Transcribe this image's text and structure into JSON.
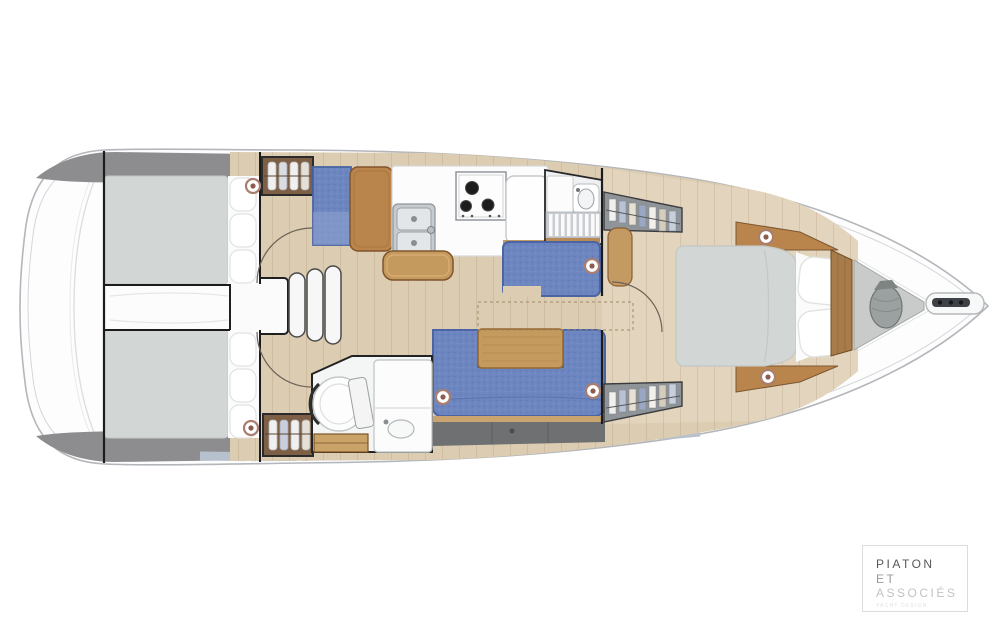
{
  "page": {
    "background": "#ffffff"
  },
  "watermark": {
    "line1": "PIATON",
    "line2": "ET",
    "line3": "ASSOCIÉS",
    "tagline": "YACHT DESIGN"
  },
  "colors": {
    "hull_stroke": "#b3b6ba",
    "deck_shadow_gray": "#8d8d8f",
    "window_band": "#b7c1cd",
    "side_deck_gray": "#9aa0a6",
    "floor_wood": "#dccdb2",
    "forward_floor_wood": "#e9dec7",
    "furniture_wood": "#b9854c",
    "table_wood": "#c59a5e",
    "upholstery_blue": "#6d86c0",
    "mattress_gray": "#d2d7d5",
    "locker_front_gray": "#6e7072",
    "anchor_locker_gray": "#c8cbc9",
    "speaker_ring": "#a97e6e"
  }
}
